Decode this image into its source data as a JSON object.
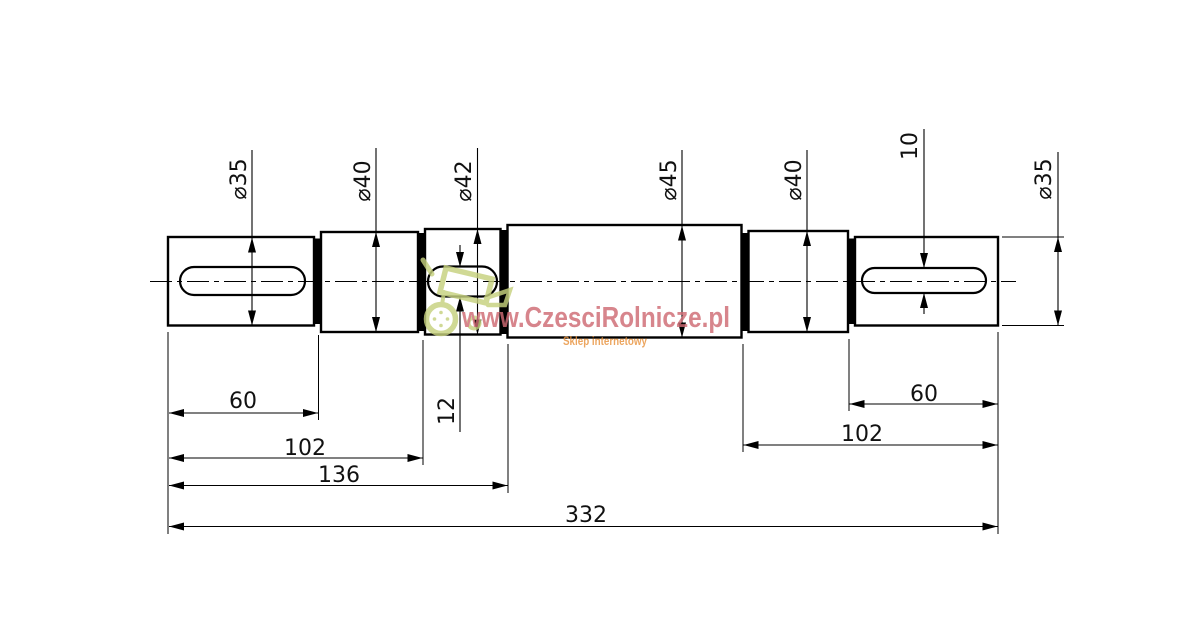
{
  "drawing": {
    "title": "shaft-technical-drawing",
    "diameter_labels": {
      "d35_left": "⌀35",
      "d40_left": "⌀40",
      "d42": "⌀42",
      "d45": "⌀45",
      "d40_right": "⌀40",
      "d35_right": "⌀35"
    },
    "keyway_labels": {
      "width_12": "12",
      "width_10": "10"
    },
    "length_labels": {
      "seg_60_left": "60",
      "seg_102_left": "102",
      "seg_136": "136",
      "total_332": "332",
      "seg_60_right": "60",
      "seg_102_right": "102"
    },
    "shaft": {
      "sections": [
        {
          "diameter": 35,
          "keyway": true
        },
        {
          "diameter": 40,
          "keyway": false
        },
        {
          "diameter": 42,
          "keyway": true,
          "keyway_width": 12
        },
        {
          "diameter": 45,
          "keyway": false
        },
        {
          "diameter": 40,
          "keyway": false
        },
        {
          "diameter": 35,
          "keyway": true,
          "keyway_width": 10
        }
      ],
      "lengths": {
        "first_step": 60,
        "second_step": 102,
        "third_step": 136,
        "total": 332,
        "last_step": 60,
        "last_two_steps": 102
      }
    },
    "line_color": "#000000",
    "background_color": "#ffffff"
  },
  "watermark": {
    "url": "www.CzesciRolnicze.pl",
    "tagline": "Sklep internetowy",
    "url_color": "#cf6b74",
    "tagline_color": "#e8923c",
    "logo_color": "#c6d17e"
  }
}
